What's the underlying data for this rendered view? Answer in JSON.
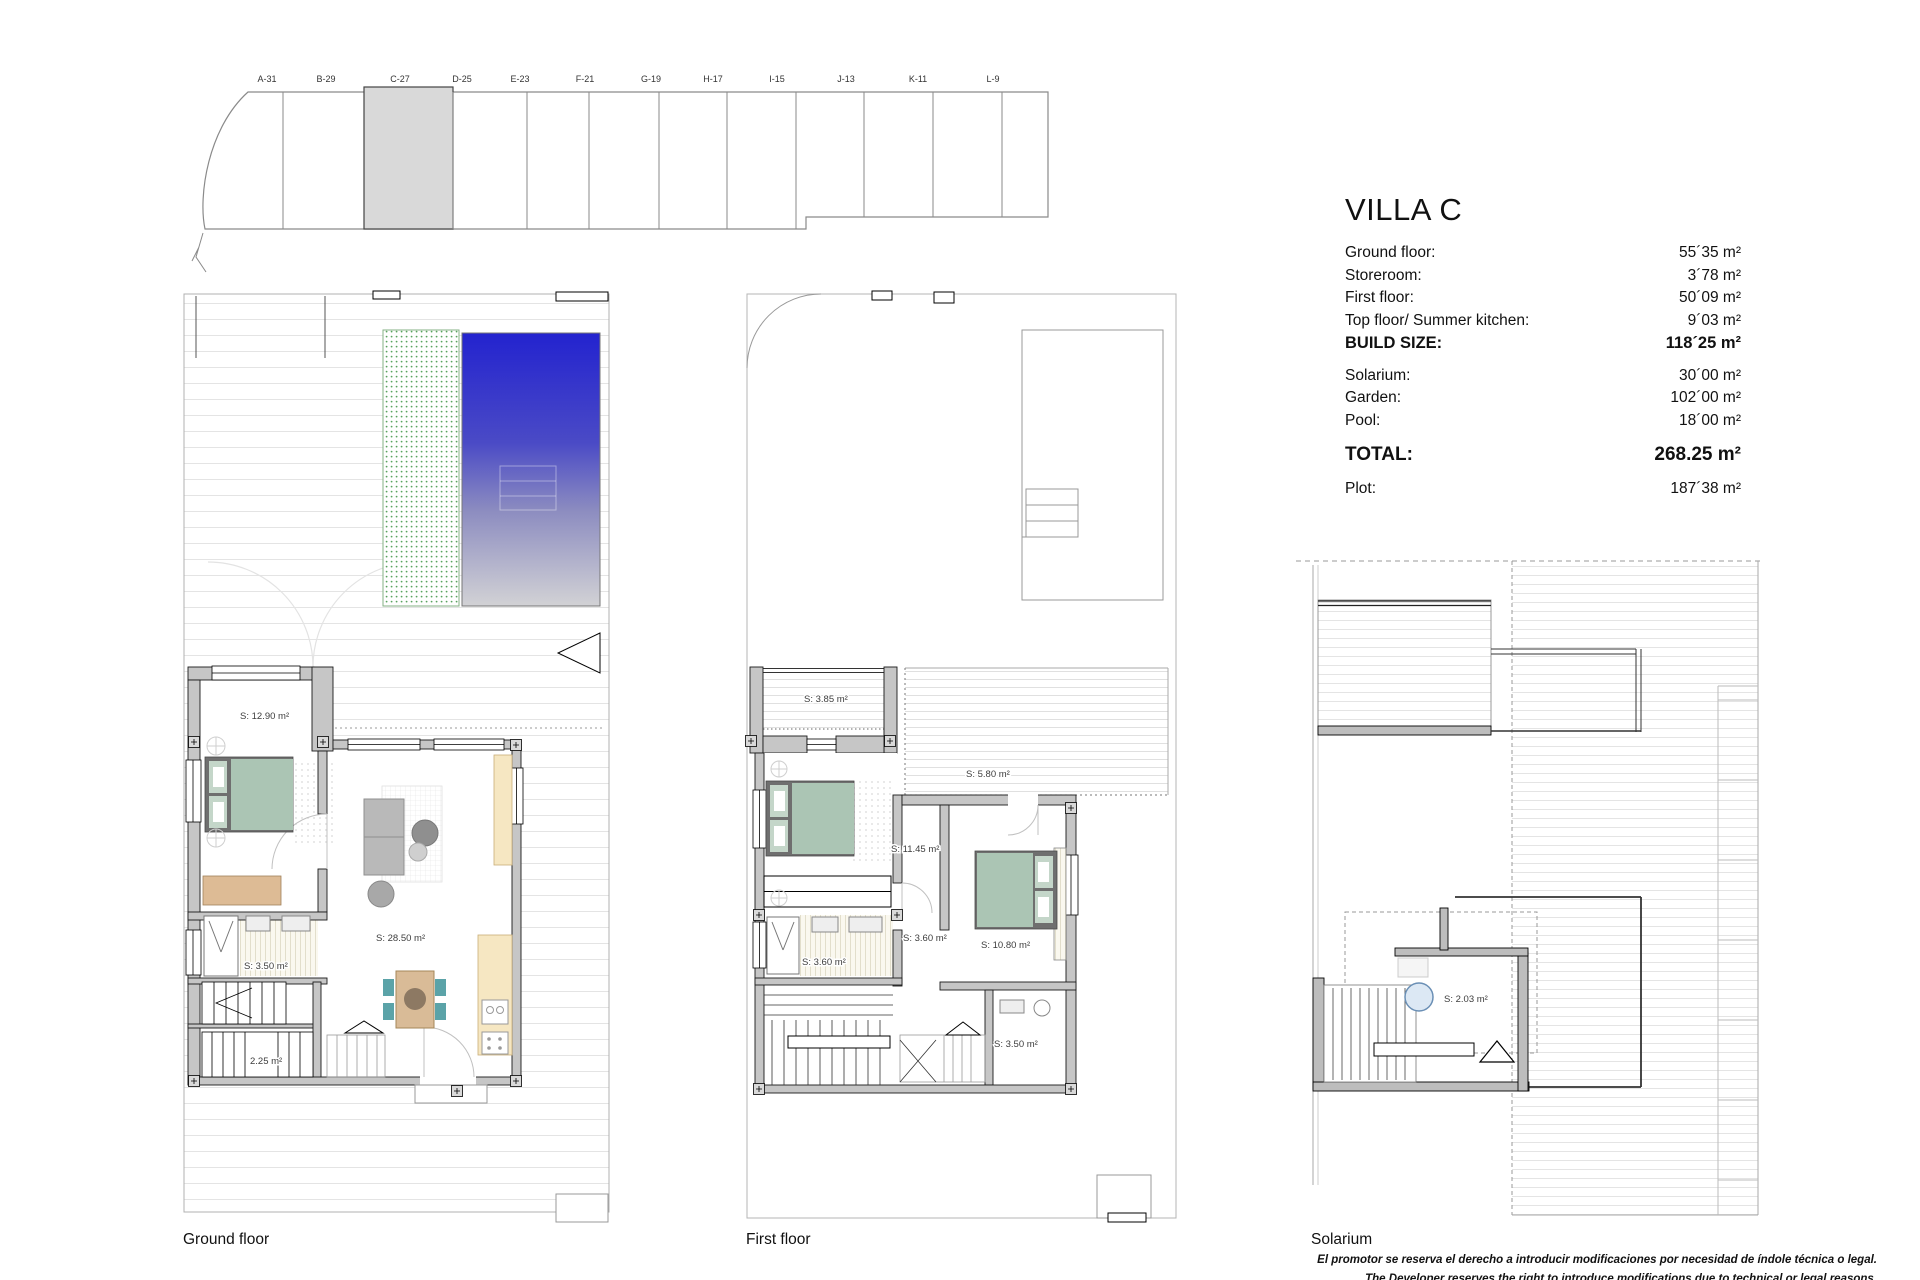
{
  "site_plan": {
    "lots": [
      "A-31",
      "B-29",
      "C-27",
      "D-25",
      "E-23",
      "F-21",
      "G-19",
      "H-17",
      "I-15",
      "J-13",
      "K-11",
      "L-9"
    ],
    "highlighted_lot": "C-27"
  },
  "spec": {
    "title": "VILLA C",
    "rows": [
      {
        "label": "Ground floor:",
        "value": "55´35 m²"
      },
      {
        "label": "Storeroom:",
        "value": "3´78 m²"
      },
      {
        "label": "First floor:",
        "value": "50´09 m²"
      },
      {
        "label": "Top floor/ Summer kitchen:",
        "value": "9´03 m²"
      },
      {
        "label": "BUILD SIZE:",
        "value": "118´25 m²"
      },
      {
        "label": "Solarium:",
        "value": "30´00 m²"
      },
      {
        "label": "Garden:",
        "value": "102´00 m²"
      },
      {
        "label": "Pool:",
        "value": "18´00 m²"
      },
      {
        "label": "TOTAL:",
        "value": "268.25 m²"
      },
      {
        "label": "Plot:",
        "value": "187´38 m²"
      }
    ]
  },
  "plans": [
    {
      "name": "Ground floor",
      "rooms": [
        "S: 12.90 m²",
        "S: 3.50 m²",
        "2.25 m²",
        "S: 28.50 m²"
      ]
    },
    {
      "name": "First floor",
      "rooms": [
        "S: 3.85 m²",
        "S: 5.80 m²",
        "S: 11.45 m²",
        "S: 3.60 m²",
        "S: 3.60 m²",
        "S: 10.80 m²",
        "S: 3.50 m²"
      ]
    },
    {
      "name": "Solarium",
      "rooms": [
        "S: 2.03 m²"
      ]
    }
  ],
  "footer": {
    "disclaimer_es": "El promotor se reserva el derecho a introducir modificaciones por necesidad de índole técnica o legal.",
    "disclaimer_en": "The Developer reserves the right to introduce modifications due to technical or legal reasons."
  },
  "colors": {
    "pool_top": "#2323cf",
    "pool_mid": "#8c8cc0",
    "pool_bottom": "#d2d2d5",
    "lot_highlight": "#d9d9d9",
    "bed": "#abc5b4",
    "chair_teal": "#5ba3a8",
    "garden_dot": "#58a25e"
  }
}
